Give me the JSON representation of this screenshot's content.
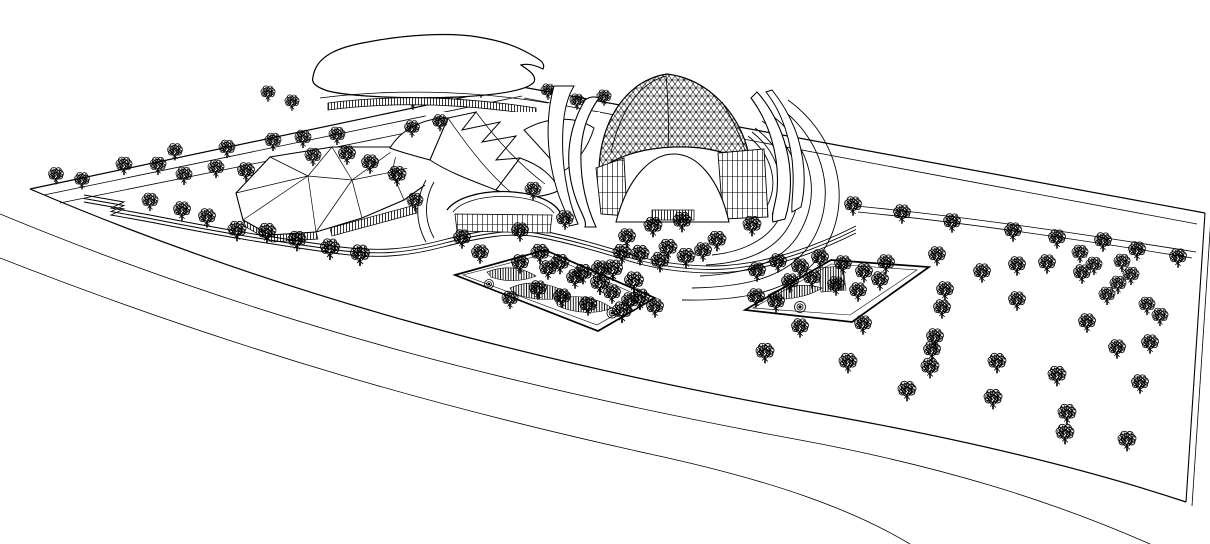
{
  "scene": {
    "type": "architectural site plan aerial line rendering",
    "style": "black ink contour drawing on white, CAD perspective",
    "background_color": "#ffffff",
    "ink_color": "#000000",
    "canvas": {
      "width": 1210,
      "height": 544
    }
  },
  "buildings": [
    {
      "id": "blob-roof-hall",
      "label": "freeform blob roof hall with louver band"
    },
    {
      "id": "faceted-canopy",
      "label": "triangulated faceted canopy pavilion on thin columns"
    },
    {
      "id": "curved-roof-hall",
      "label": "swooping curved roof hall with arched glazed entry"
    },
    {
      "id": "gridshell-dome",
      "label": "triangulated gridshell dome with white petal shells and curtain wall base"
    }
  ],
  "landscape": {
    "garden_plot_count": 2,
    "plaza_arc_count": 7,
    "road_count": 3,
    "tree_count": 126,
    "trees_back": [
      [
        268,
        92,
        0.75
      ],
      [
        292,
        101,
        0.75
      ],
      [
        413,
        100,
        0.75
      ],
      [
        447,
        94,
        0.75
      ],
      [
        481,
        88,
        0.75
      ],
      [
        548,
        90,
        0.75
      ],
      [
        577,
        100,
        0.75
      ],
      [
        604,
        96,
        0.75
      ]
    ],
    "trees": [
      [
        56,
        174,
        0.8
      ],
      [
        82,
        179,
        0.8
      ],
      [
        124,
        164,
        0.85
      ],
      [
        158,
        164,
        0.85
      ],
      [
        184,
        174,
        0.85
      ],
      [
        216,
        167,
        0.85
      ],
      [
        246,
        170,
        0.9
      ],
      [
        175,
        150,
        0.8
      ],
      [
        227,
        147,
        0.85
      ],
      [
        273,
        140,
        0.85
      ],
      [
        303,
        137,
        0.85
      ],
      [
        337,
        134,
        0.85
      ],
      [
        313,
        155,
        0.85
      ],
      [
        347,
        153,
        0.9
      ],
      [
        370,
        162,
        0.9
      ],
      [
        397,
        174,
        0.95
      ],
      [
        150,
        200,
        0.85
      ],
      [
        182,
        209,
        0.9
      ],
      [
        207,
        216,
        0.9
      ],
      [
        237,
        229,
        0.95
      ],
      [
        267,
        231,
        0.95
      ],
      [
        297,
        239,
        0.95
      ],
      [
        330,
        247,
        1
      ],
      [
        360,
        253,
        1
      ],
      [
        412,
        127,
        0.8
      ],
      [
        440,
        121,
        0.8
      ],
      [
        415,
        200,
        0.85
      ],
      [
        462,
        237,
        0.9
      ],
      [
        480,
        252,
        0.9
      ],
      [
        520,
        230,
        0.9
      ],
      [
        533,
        189,
        0.85
      ],
      [
        565,
        218,
        0.9
      ],
      [
        627,
        236,
        0.9
      ],
      [
        653,
        225,
        0.95
      ],
      [
        682,
        220,
        0.95
      ],
      [
        717,
        239,
        0.95
      ],
      [
        752,
        224,
        0.95
      ],
      [
        613,
        268,
        1
      ],
      [
        634,
        280,
        1
      ],
      [
        668,
        247,
        0.95
      ],
      [
        640,
        253,
        0.95
      ],
      [
        660,
        260,
        0.95
      ],
      [
        686,
        256,
        0.95
      ],
      [
        703,
        250,
        0.9
      ],
      [
        622,
        252,
        0.95
      ],
      [
        640,
        297,
        1
      ],
      [
        622,
        310,
        1
      ],
      [
        600,
        282,
        1
      ],
      [
        583,
        272,
        0.95
      ],
      [
        560,
        262,
        0.95
      ],
      [
        540,
        252,
        0.95
      ],
      [
        520,
        262,
        0.9
      ],
      [
        548,
        268,
        0.9
      ],
      [
        575,
        277,
        0.9
      ],
      [
        600,
        268,
        0.9
      ],
      [
        538,
        288,
        0.9
      ],
      [
        562,
        296,
        0.9
      ],
      [
        588,
        304,
        0.9
      ],
      [
        612,
        292,
        0.9
      ],
      [
        510,
        298,
        0.85
      ],
      [
        630,
        300,
        0.9
      ],
      [
        655,
        306,
        0.9
      ],
      [
        757,
        270,
        0.9
      ],
      [
        778,
        261,
        0.9
      ],
      [
        800,
        266,
        0.9
      ],
      [
        820,
        257,
        0.9
      ],
      [
        843,
        263,
        0.9
      ],
      [
        864,
        271,
        0.9
      ],
      [
        886,
        262,
        0.9
      ],
      [
        790,
        281,
        0.9
      ],
      [
        812,
        277,
        0.9
      ],
      [
        836,
        284,
        0.9
      ],
      [
        858,
        290,
        0.9
      ],
      [
        880,
        279,
        0.9
      ],
      [
        756,
        296,
        0.9
      ],
      [
        776,
        301,
        0.9
      ],
      [
        853,
        204,
        0.9
      ],
      [
        902,
        212,
        0.9
      ],
      [
        952,
        221,
        0.9
      ],
      [
        1013,
        230,
        0.9
      ],
      [
        1057,
        237,
        0.9
      ],
      [
        1103,
        240,
        0.9
      ],
      [
        1137,
        249,
        0.9
      ],
      [
        1178,
        256,
        0.9
      ],
      [
        1080,
        252,
        0.85
      ],
      [
        1094,
        264,
        0.85
      ],
      [
        1122,
        261,
        0.85
      ],
      [
        1131,
        274,
        0.85
      ],
      [
        1118,
        283,
        0.85
      ],
      [
        1107,
        294,
        0.85
      ],
      [
        1147,
        304,
        0.85
      ],
      [
        1160,
        315,
        0.85
      ],
      [
        937,
        254,
        0.9
      ],
      [
        982,
        271,
        0.9
      ],
      [
        1017,
        264,
        0.9
      ],
      [
        1047,
        262,
        0.9
      ],
      [
        1082,
        272,
        0.9
      ],
      [
        945,
        289,
        0.9
      ],
      [
        1017,
        299,
        0.9
      ],
      [
        942,
        307,
        0.9
      ],
      [
        1087,
        321,
        0.9
      ],
      [
        935,
        336,
        0.9
      ],
      [
        1150,
        342,
        0.9
      ],
      [
        1117,
        347,
        0.9
      ],
      [
        930,
        366,
        0.95
      ],
      [
        997,
        361,
        0.95
      ],
      [
        1057,
        374,
        0.95
      ],
      [
        1140,
        382,
        0.9
      ],
      [
        1067,
        412,
        0.95
      ],
      [
        993,
        397,
        0.95
      ],
      [
        1127,
        439,
        0.95
      ],
      [
        848,
        361,
        0.95
      ],
      [
        907,
        389,
        0.95
      ],
      [
        932,
        349,
        0.9
      ],
      [
        1065,
        432,
        0.95
      ],
      [
        765,
        351,
        0.95
      ],
      [
        800,
        326,
        0.9
      ],
      [
        863,
        323,
        0.9
      ]
    ]
  }
}
